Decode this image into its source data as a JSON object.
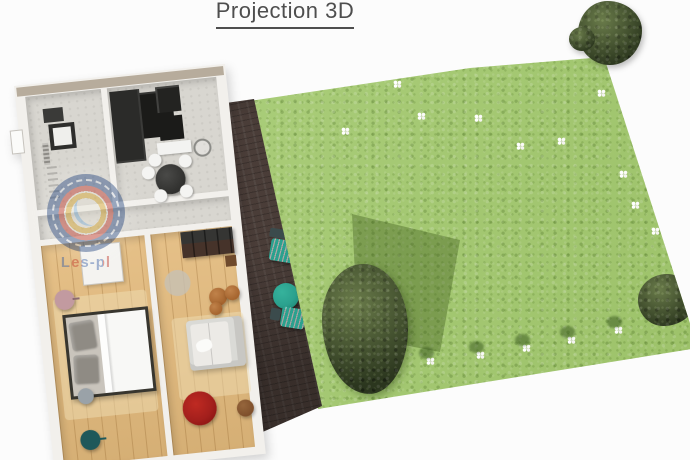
{
  "header": {
    "title": "Projection 3D"
  },
  "watermark": {
    "label": "Les-pl"
  },
  "colors": {
    "bg": "#fcfcfc",
    "title": "#4e4e4e",
    "grass": "#a6cc71",
    "tree": "#3e4e2b",
    "deck": "#4b3e39",
    "wall": "#f2f0ec",
    "wall-top": "#b7ac9c",
    "floor-gray": "#d8d6d0",
    "floor-wood": "#e3ba7c",
    "rug-light": "#f0ddb4",
    "teal": "#2ba18e",
    "teal-dark": "#3b4b4c",
    "bed-frame": "#38362f",
    "pillow": "#8f8b84",
    "duvet": "#f8f8f6",
    "sofa": "#dadad6",
    "rug-red": "#a31f1c",
    "rug-gray": "#c7c0b4",
    "pouf-brown": "#a5642e",
    "pouf-teal": "#1f585a",
    "chair-pink": "#c29aa0",
    "stool-gray": "#9aa2a8",
    "counter-dark": "#2b2b29",
    "appliance": "#1b1b19",
    "counter-white": "#f3f3f1",
    "cabinet": "#46332a",
    "wm-blue": "#2c4d85",
    "wm-red": "#c23b2e",
    "wm-yellow": "#d8a62b"
  },
  "garden": {
    "flowers": [
      {
        "x": 397,
        "y": 84
      },
      {
        "x": 345,
        "y": 131
      },
      {
        "x": 421,
        "y": 116
      },
      {
        "x": 478,
        "y": 118
      },
      {
        "x": 520,
        "y": 146
      },
      {
        "x": 561,
        "y": 141
      },
      {
        "x": 601,
        "y": 93
      },
      {
        "x": 623,
        "y": 174
      },
      {
        "x": 635,
        "y": 205
      },
      {
        "x": 655,
        "y": 231
      },
      {
        "x": 430,
        "y": 361,
        "shadow": true
      },
      {
        "x": 480,
        "y": 355,
        "shadow": true
      },
      {
        "x": 526,
        "y": 348,
        "shadow": true
      },
      {
        "x": 571,
        "y": 340,
        "shadow": true
      },
      {
        "x": 618,
        "y": 330,
        "shadow": true
      }
    ]
  }
}
